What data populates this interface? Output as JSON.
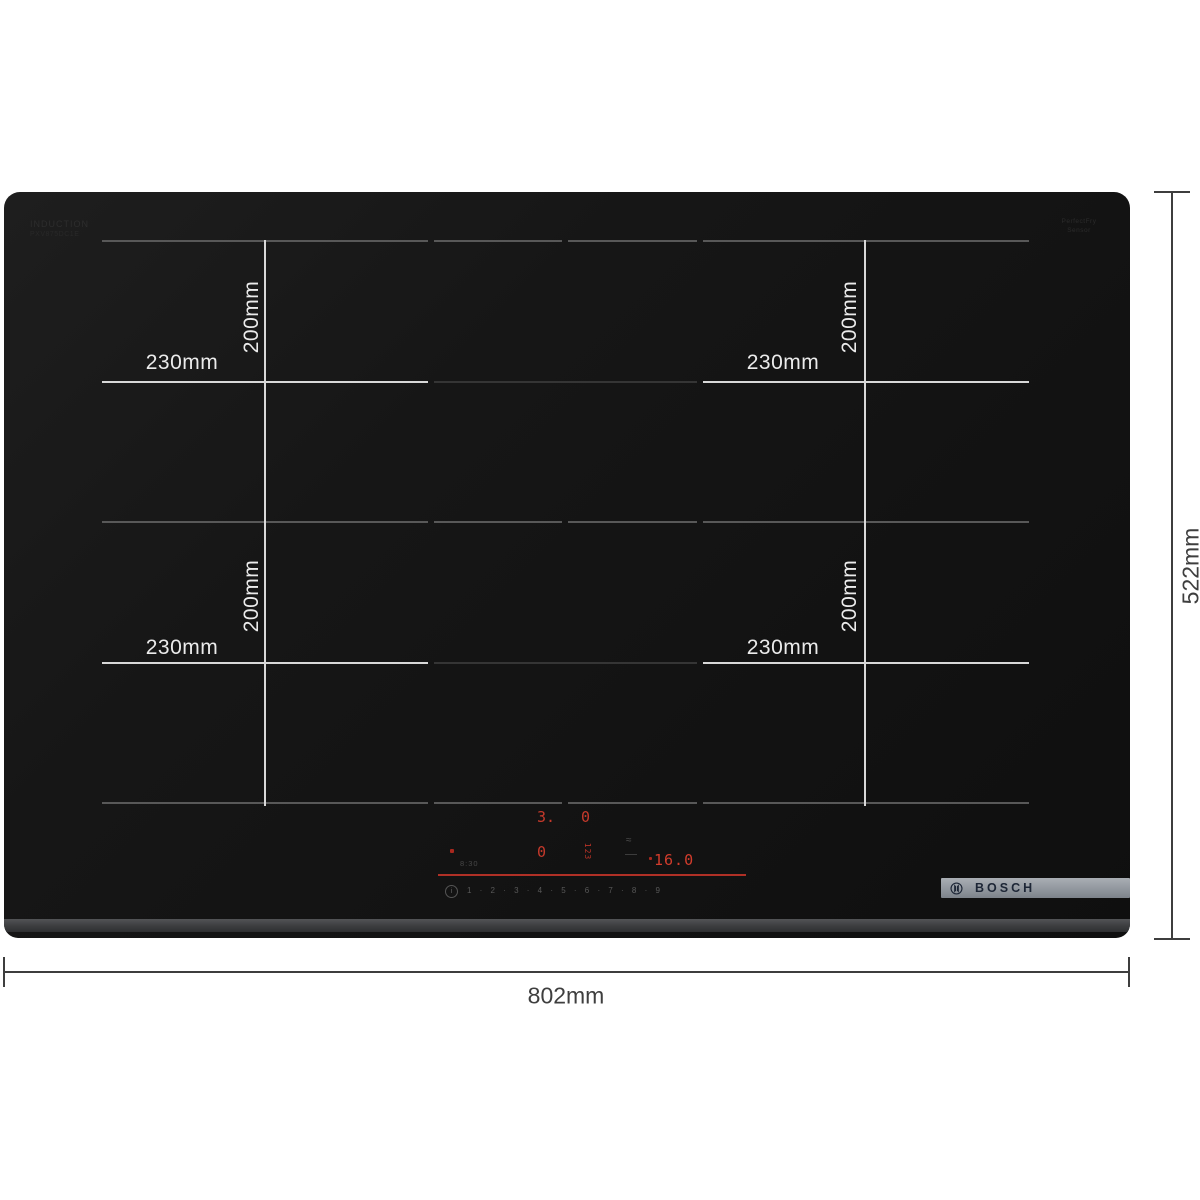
{
  "brand": {
    "name": "BOSCH"
  },
  "dimensions": {
    "overall_width": "802mm",
    "overall_height": "522mm",
    "zone_width": "230mm",
    "zone_height": "200mm"
  },
  "glass_prints": {
    "top_left_line1": "INDUCTION",
    "top_left_line2": "PXV875DC1E",
    "top_right_line1": "PerfectFry",
    "top_right_line2": "Sensor"
  },
  "control_panel": {
    "zone_digit_upper_left": "3.",
    "zone_digit_upper_right": "0",
    "zone_digit_lower_left": "0",
    "side_digits": "123",
    "timer_value": "16.0",
    "clock_value": "8:30",
    "power_scale": "1 · 2 · 3 · 4 · 5 · 6 · 7 · 8 · 9",
    "info_icon": "i"
  },
  "colors": {
    "glass": "#151515",
    "zone_line": "#585858",
    "dimension_line_on_glass": "#d8d8d8",
    "annotation": "#3e3e3e",
    "display_red": "#c2372b",
    "bezel": "#3d3e40",
    "badge_gradient_top": "#a9aeb4",
    "badge_gradient_bottom": "#7d838a"
  }
}
